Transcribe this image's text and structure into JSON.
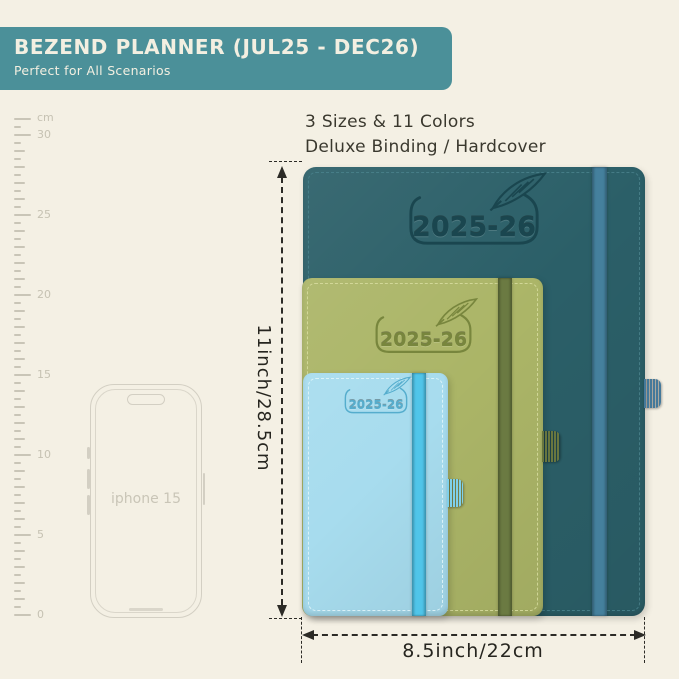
{
  "banner": {
    "title": "BEZEND PLANNER (JUL25 - DEC26)",
    "subtitle": "Perfect for All Scenarios",
    "bg_color": "#4b9099",
    "text_color": "#f3efe1"
  },
  "headline": {
    "line1": "3 Sizes & 11 Colors",
    "line2": "Deluxe Binding / Hardcover"
  },
  "ruler": {
    "unit_label": "cm",
    "tick_labels": [
      "30",
      "25",
      "20",
      "15",
      "10",
      "5",
      "0"
    ]
  },
  "phone": {
    "label": "iphone 15"
  },
  "planners": [
    {
      "size": "large",
      "year_label": "2025-26",
      "cover_color": "#2b5f68",
      "emboss_color": "#1a464f",
      "band_color": "#45809d",
      "stitch_color": "#4a828c",
      "loop_color": "#45799a"
    },
    {
      "size": "medium",
      "year_label": "2025-26",
      "cover_color": "#abb567",
      "emboss_color": "#78863d",
      "band_color": "#6b7a42",
      "stitch_color": "#d8dda0",
      "loop_color": "#68763f"
    },
    {
      "size": "small",
      "year_label": "2025-26",
      "cover_color": "#a7dcee",
      "emboss_color": "#55adcd",
      "band_color": "#50c5e9",
      "stitch_color": "#e4f6fa",
      "loop_color": "#7fd0ea"
    }
  ],
  "dimensions": {
    "height_label": "11inch/28.5cm",
    "width_label": "8.5inch/22cm"
  }
}
